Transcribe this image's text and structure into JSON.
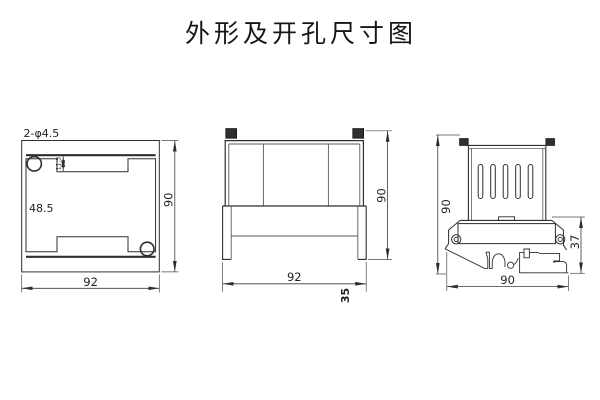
{
  "title": "外形及开孔尺寸图",
  "left_view": {
    "hole_callout": "2-φ4.5",
    "panel_label": "48.5",
    "notch_dim": "11.3",
    "height": "90",
    "width": "92"
  },
  "middle_view": {
    "height": "90",
    "width": "92",
    "depth": "35"
  },
  "right_view": {
    "height": "90",
    "width": "90",
    "bracket": "37"
  }
}
